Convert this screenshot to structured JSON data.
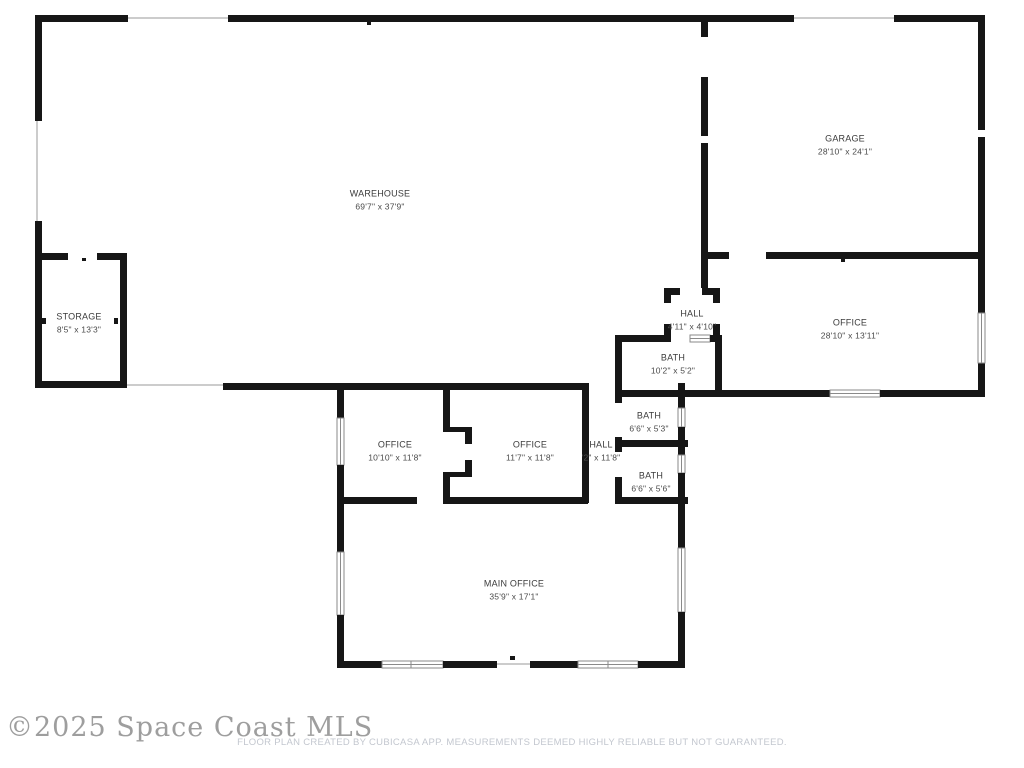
{
  "watermark": "©2025 Space Coast MLS",
  "disclaimer": "FLOOR PLAN CREATED BY CUBICASA APP. MEASUREMENTS DEEMED HIGHLY RELIABLE BUT NOT GUARANTEED.",
  "rooms": [
    {
      "name": "WAREHOUSE",
      "dims": "69'7\" x 37'9\""
    },
    {
      "name": "GARAGE",
      "dims": "28'10\" x 24'1\""
    },
    {
      "name": "STORAGE",
      "dims": "8'5\" x 13'3\""
    },
    {
      "name": "HALL",
      "dims": "4'11\" x 4'10\""
    },
    {
      "name": "BATH",
      "dims": "10'2\" x 5'2\""
    },
    {
      "name": "OFFICE",
      "dims": "28'10\" x 13'11\""
    },
    {
      "name": "BATH",
      "dims": "6'6\" x 5'3\""
    },
    {
      "name": "OFFICE",
      "dims": "10'10\" x 11'8\""
    },
    {
      "name": "OFFICE",
      "dims": "11'7\" x 11'8\""
    },
    {
      "name": "HALL",
      "dims": "'2\" x 11'8\""
    },
    {
      "name": "BATH",
      "dims": "6'6\" x 5'6\""
    },
    {
      "name": "MAIN OFFICE",
      "dims": "35'9\" x 17'1\""
    }
  ],
  "colors": {
    "wall": "#161616",
    "label_text": "#3b3b3b",
    "window_frame": "#8a8a8a",
    "opening_line": "#cccccc",
    "watermark": "#9e9e9e",
    "disclaimer": "#c3c7cf",
    "background": "#ffffff"
  }
}
